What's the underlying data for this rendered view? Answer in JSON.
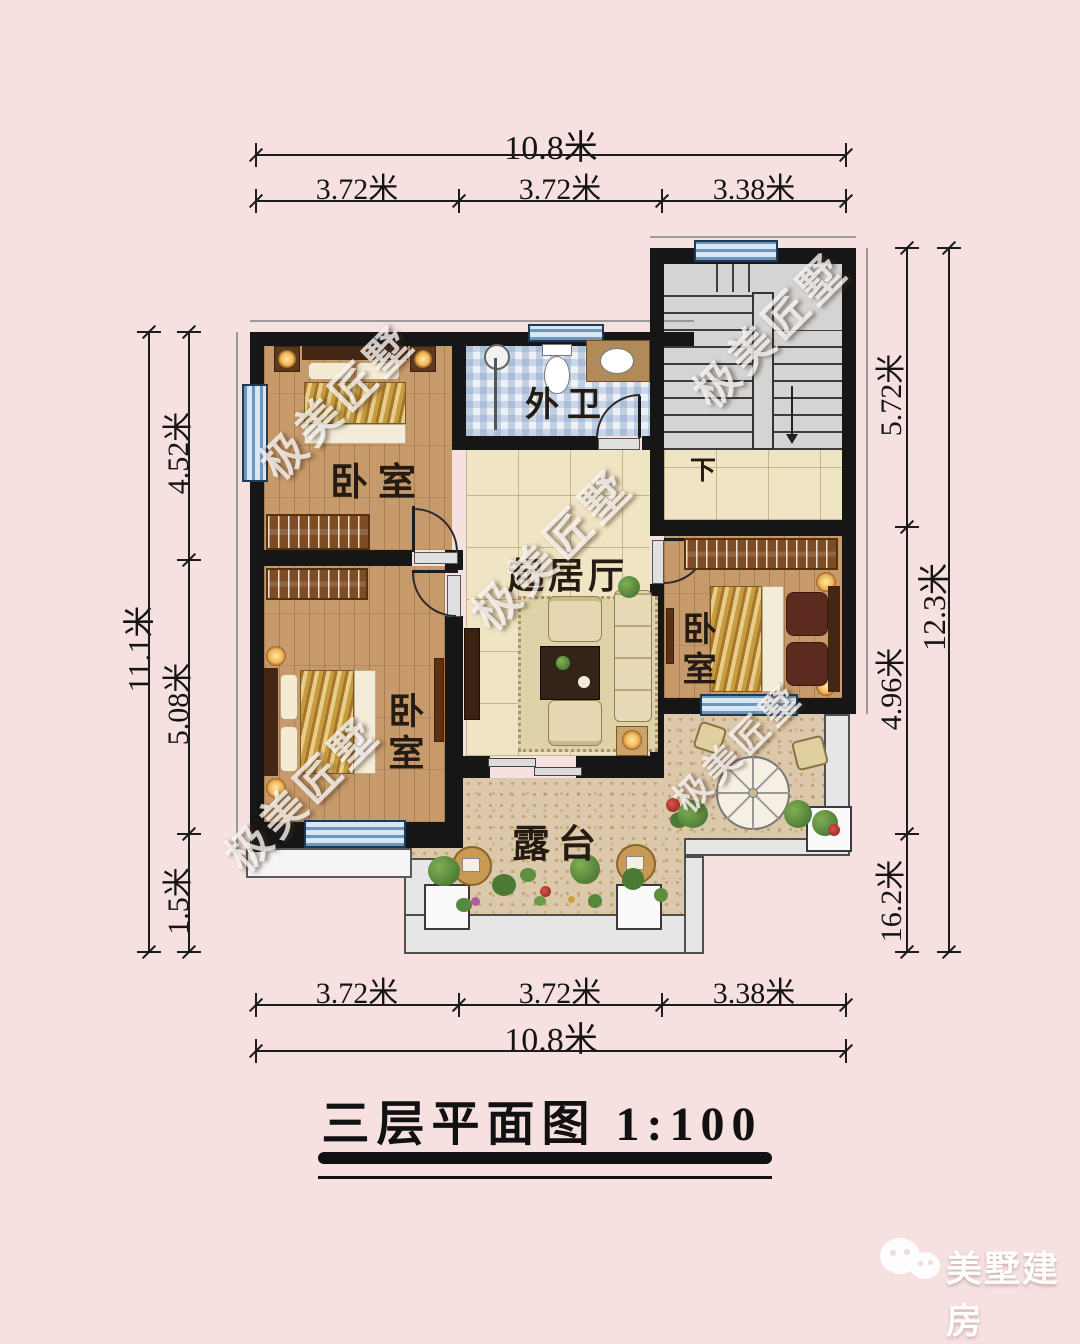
{
  "title": "三层平面图 1:100",
  "watermark": "极美匠墅",
  "logo": {
    "brand": "美墅建房",
    "icon": "wechat-icon"
  },
  "dimensions": {
    "top": {
      "total": "10.8米",
      "segments": [
        "3.72米",
        "3.72米",
        "3.38米"
      ]
    },
    "bottom": {
      "total": "10.8米",
      "segments": [
        "3.72米",
        "3.72米",
        "3.38米"
      ]
    },
    "left": {
      "total": "11.1米",
      "segments": [
        "4.52米",
        "5.08米",
        "1.5米"
      ]
    },
    "right": {
      "total": "12.3米",
      "segments": [
        "5.72米",
        "4.96米",
        "16.2米"
      ]
    }
  },
  "rooms": {
    "bedroom_top_left": "卧室",
    "bedroom_bottom_left": "卧室",
    "bedroom_right": "卧室",
    "bathroom": "外卫",
    "living_room": "起居厅",
    "terrace": "露台",
    "stair_direction": "下"
  },
  "colors": {
    "background": "#f6e1e0",
    "wall": "#161616",
    "wood_floor": "#c79a6b",
    "tile_floor": "#efe4c3",
    "bath_tile": "#eef2f7",
    "stair_floor": "#d4d4d4",
    "terrace_floor": "#dcc8aa",
    "window_blue": "#6e97c0"
  }
}
